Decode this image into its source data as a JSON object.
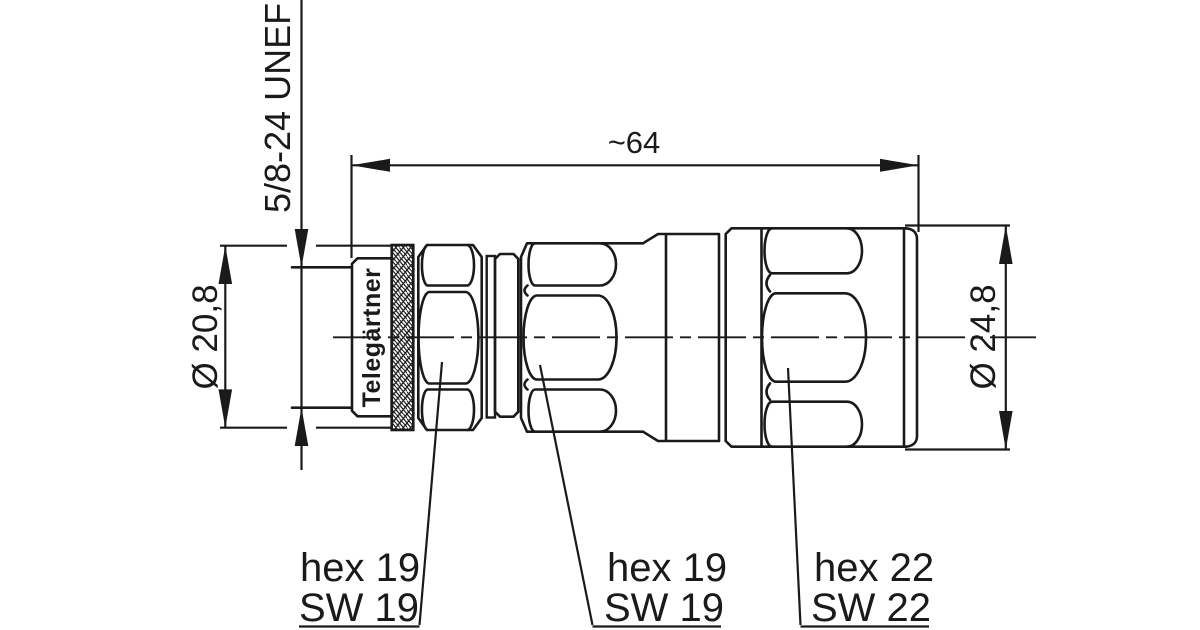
{
  "drawing": {
    "brand": "Telegärtner",
    "thread_spec": "5/8-24 UNEF",
    "length_dimension": "~64",
    "left_diameter": "Ø 20,8",
    "right_diameter": "Ø 24,8",
    "callouts": [
      {
        "line1": "hex 19",
        "line2": "SW 19"
      },
      {
        "line1": "hex 19",
        "line2": "SW 19"
      },
      {
        "line1": "hex 22",
        "line2": "SW 22"
      }
    ],
    "colors": {
      "line": "#1a1a1a",
      "background": "#ffffff"
    }
  }
}
